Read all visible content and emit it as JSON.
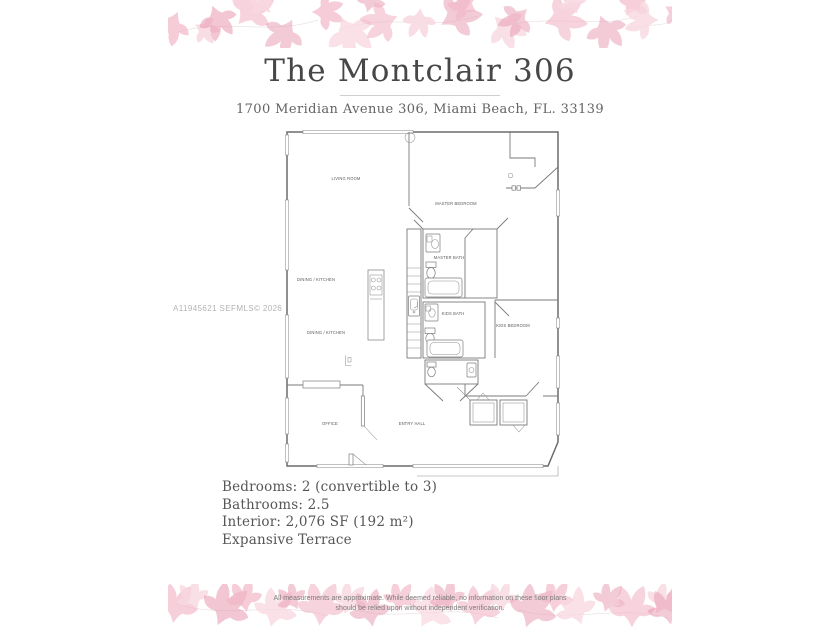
{
  "page": {
    "title": "The Montclair 306",
    "address": "1700 Meridian Avenue 306, Miami Beach, FL. 33139"
  },
  "watermark": "A11945621  SEFMLS© 2026",
  "floorplan": {
    "labels": {
      "living_room": "LIVING ROOM",
      "master_bedroom": "MASTER BEDROOM",
      "master_bath": "MASTER BATH",
      "dining_kitchen_upper": "DINING / KITCHEN",
      "dining_kitchen_lower": "DINING / KITCHEN",
      "kids_bath": "KIDS BATH",
      "kids_bedroom": "KIDS BEDROOM",
      "office": "OFFICE",
      "entry_hall": "ENTRY HALL"
    }
  },
  "details": {
    "lines": [
      "Bedrooms: 2 (convertible to 3)",
      "Bathrooms: 2.5",
      "Interior: 2,076 SF (192 m²)",
      "Expansive Terrace"
    ]
  },
  "disclaimer": {
    "line1": "All measurements are approximate. While deemed reliable, no information on these floor plans",
    "line2": "should be relied upon without independent verification."
  },
  "colors": {
    "leaf_pink_deep": "#e897af",
    "leaf_pink_mid": "#f1b6c6",
    "leaf_pink_light": "#f8d7e0",
    "title_text": "#474747",
    "body_text": "#565656",
    "plan_line": "#6b6b6b",
    "watermark_text": "#b3b3b3"
  }
}
